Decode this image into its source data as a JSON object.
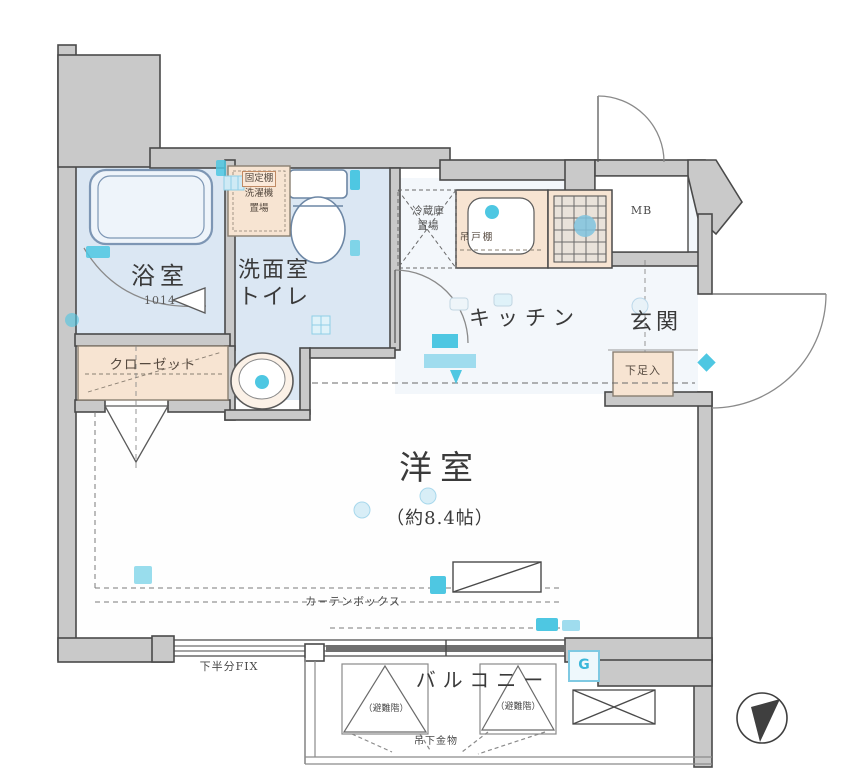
{
  "rooms": {
    "bath": {
      "label": "浴室",
      "size": "1014"
    },
    "washroom": {
      "line1": "洗面室",
      "line2": "トイレ"
    },
    "kitchen": {
      "label": "キッチン"
    },
    "entrance": {
      "label": "玄関"
    },
    "western_room": {
      "label": "洋室",
      "size": "（約8.4帖）"
    },
    "closet": {
      "label": "クローゼット"
    },
    "balcony": {
      "label": "バルコニー"
    },
    "meter_box": {
      "label": "MB"
    }
  },
  "annotations": {
    "washer": {
      "line1": "固定棚",
      "line2": "洗濯機",
      "line3": "置場"
    },
    "fridge": {
      "line1": "冷蔵庫",
      "line2": "置場"
    },
    "hanging_cupboard": "吊戸棚",
    "shoe_box": "下足入",
    "curtain_box": "カーテンボックス",
    "fix_window": "下半分FIX",
    "hanging_hardware": "吊下金物",
    "triangle_left": "（避難階）",
    "triangle_right": "（避難階）",
    "gas_meter": "G"
  },
  "colors": {
    "wall_fill": "#c9c9c9",
    "wall_line": "#4a4a4a",
    "wet_area": "#dbe7f3",
    "kitchen_area": "#f3f7fb",
    "cabinet": "#f7e4d2",
    "accent_cyan": "#4ec7e2",
    "accent_pale": "#c2e7f2"
  }
}
